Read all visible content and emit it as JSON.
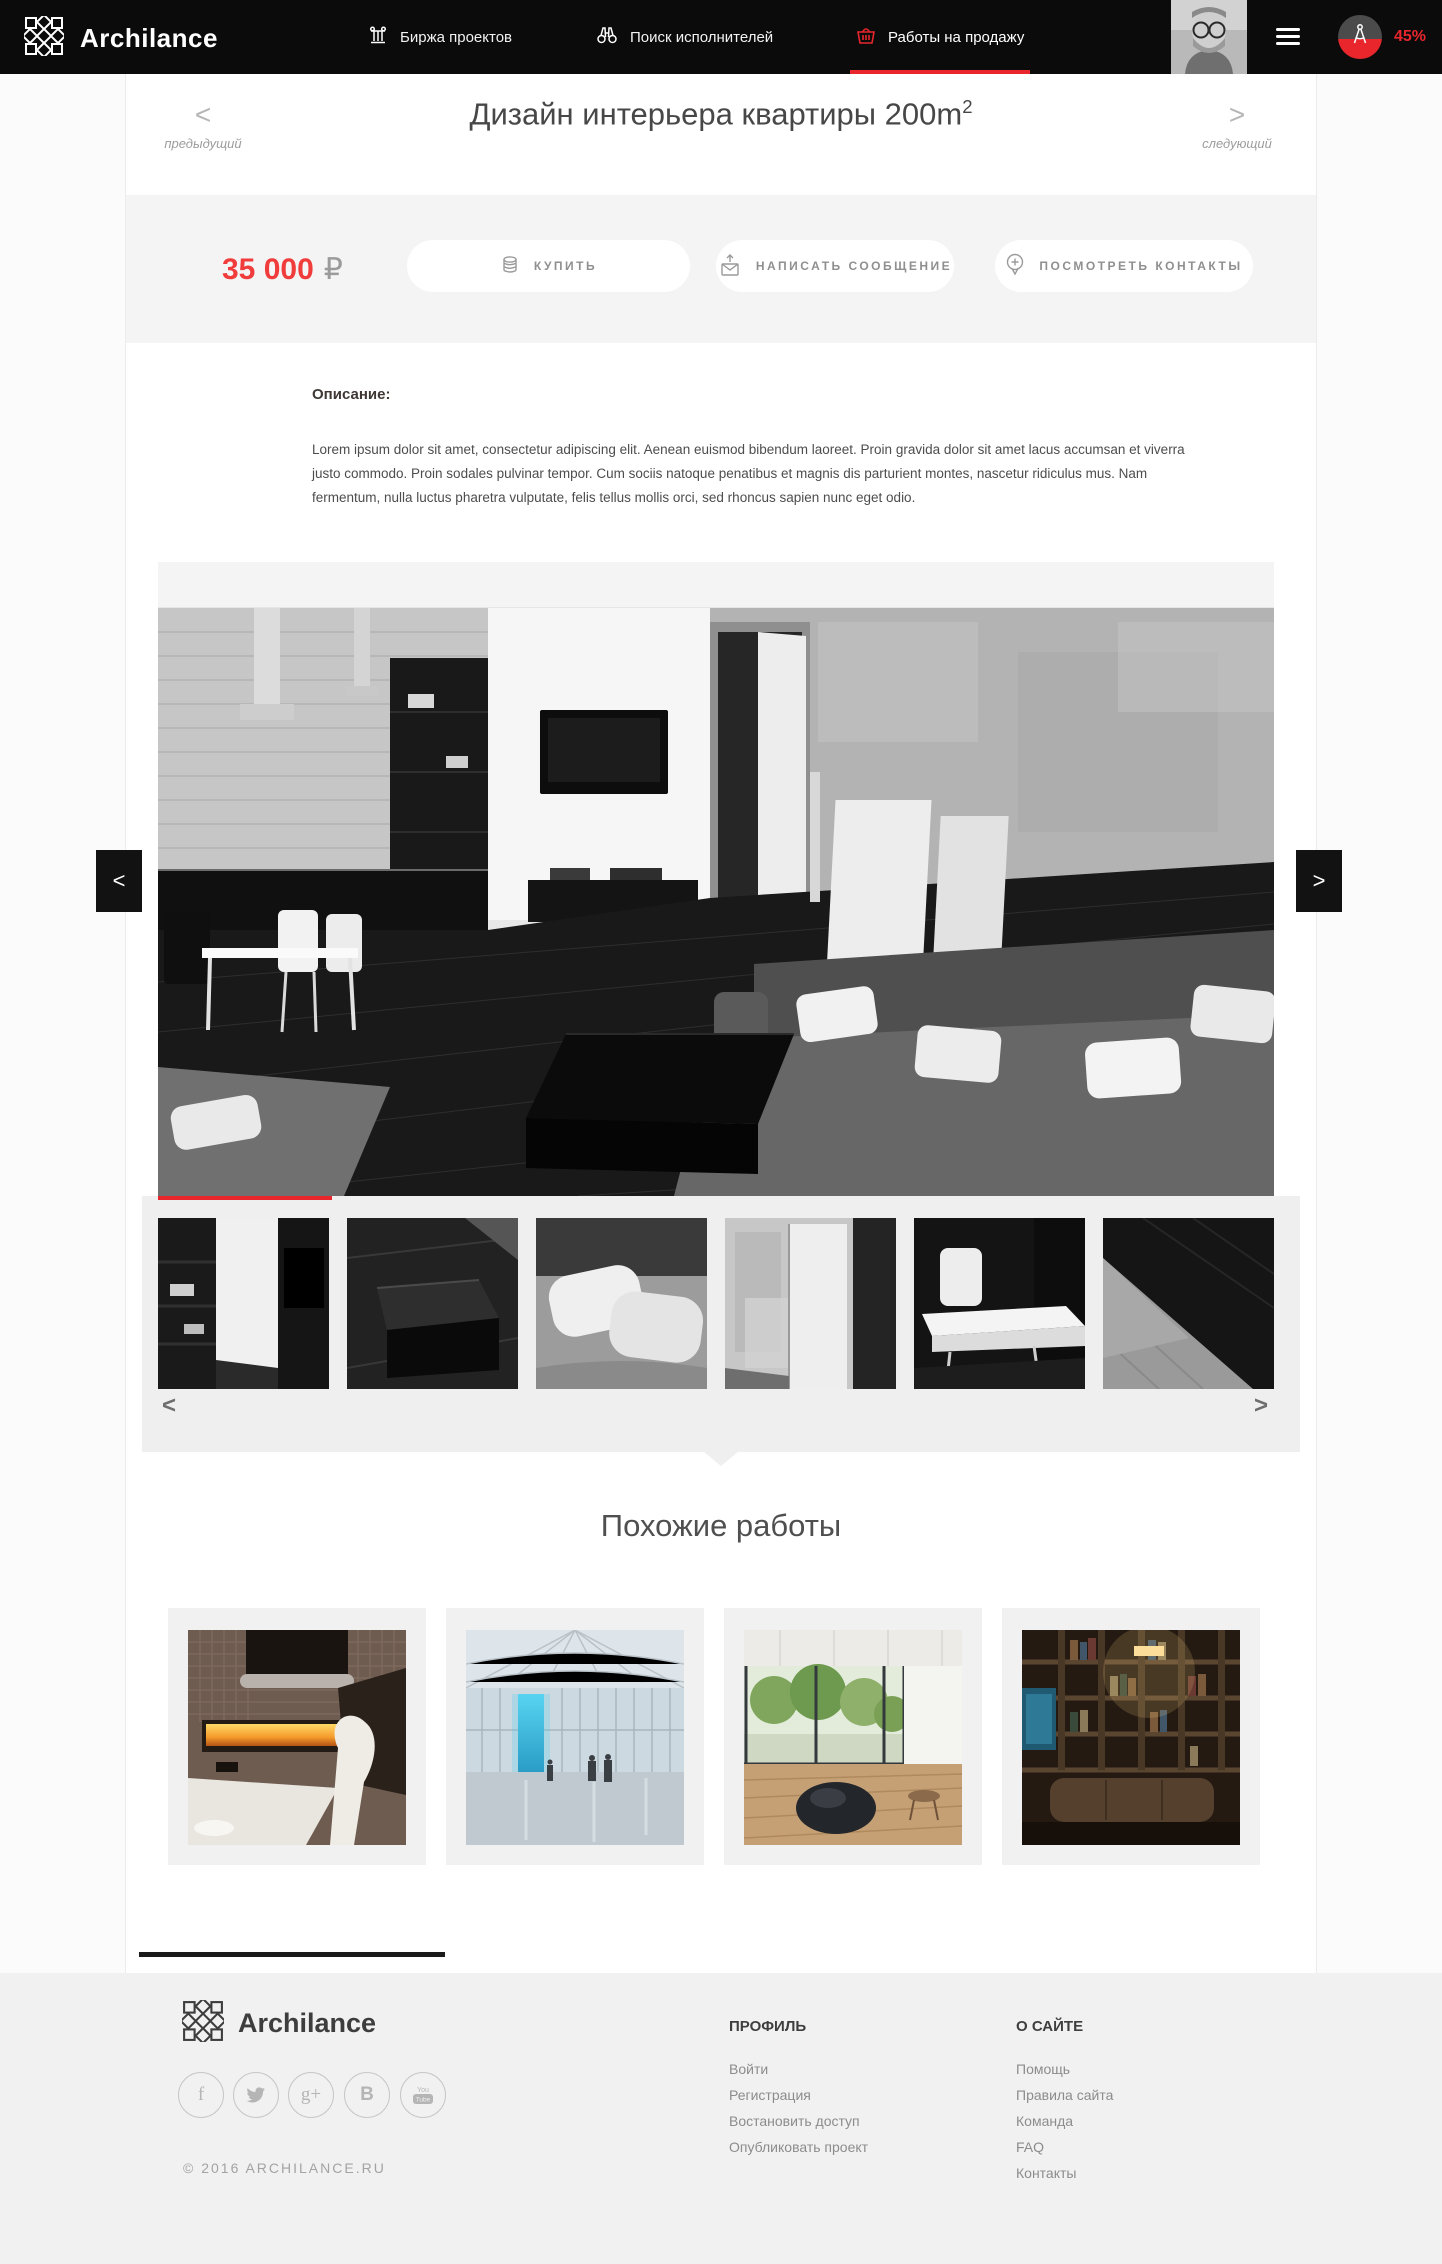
{
  "colors": {
    "accent_red": "#e8262c",
    "price_red": "#f13c3c",
    "header_bg": "#0b0b0b"
  },
  "header": {
    "brand": "Archilance",
    "nav": [
      {
        "label": "Биржа проектов",
        "icon": "column-icon",
        "active": false
      },
      {
        "label": "Поиск исполнителей",
        "icon": "binoculars-icon",
        "active": false
      },
      {
        "label": "Работы на продажу",
        "icon": "basket-icon",
        "active": true
      }
    ],
    "user": {
      "progress_label": "45%"
    }
  },
  "title_bar": {
    "title": "Дизайн интерьера квартиры 200m",
    "title_superscript": "2",
    "prev_glyph": "<",
    "next_glyph": ">",
    "prev_label": "предыдущий",
    "next_label": "следующий"
  },
  "purchase": {
    "price": "35 000",
    "currency": "₽",
    "buy_label": "КУПИТЬ",
    "message_label": "НАПИСАТЬ СООБЩЕНИЕ",
    "contacts_label": "ПОСМОТРЕТЬ КОНТАКТЫ"
  },
  "description": {
    "heading": "Описание:",
    "body": "Lorem ipsum dolor sit amet, consectetur adipiscing elit. Aenean euismod bibendum laoreet. Proin gravida dolor sit amet lacus accumsan et viverra justo commodo. Proin sodales pulvinar tempor. Cum sociis natoque penatibus et magnis dis parturient montes, nascetur ridiculus mus. Nam fermentum, nulla luctus pharetra vulputate, felis tellus mollis orci, sed rhoncus sapien nunc eget odio."
  },
  "gallery": {
    "image_prev_glyph": "<",
    "image_next_glyph": ">",
    "thumb_prev_glyph": "<",
    "thumb_next_glyph": ">",
    "thumbnails": [
      "kitchen-shelves",
      "coffee-table",
      "pillows",
      "doorway",
      "dining-set",
      "sofa-corner"
    ]
  },
  "similar": {
    "heading": "Похожие работы",
    "items": [
      "fireplace-interior",
      "mall-atrium",
      "living-room-windows",
      "home-library"
    ]
  },
  "footer": {
    "brand": "Archilance",
    "copyright": "© 2016 ARCHILANCE.RU",
    "social": [
      {
        "name": "facebook",
        "glyph": "f"
      },
      {
        "name": "twitter",
        "glyph": ""
      },
      {
        "name": "google-plus",
        "glyph": "g+"
      },
      {
        "name": "vk",
        "glyph": "В"
      },
      {
        "name": "youtube",
        "glyph": ""
      }
    ],
    "columns": [
      {
        "title": "ПРОФИЛЬ",
        "links": [
          "Войти",
          "Регистрация",
          "Востановить доступ",
          "Опубликовать проект"
        ]
      },
      {
        "title": "О САЙТЕ",
        "links": [
          "Помощь",
          "Правила сайта",
          "Команда",
          "FAQ",
          "Контакты"
        ]
      }
    ]
  }
}
